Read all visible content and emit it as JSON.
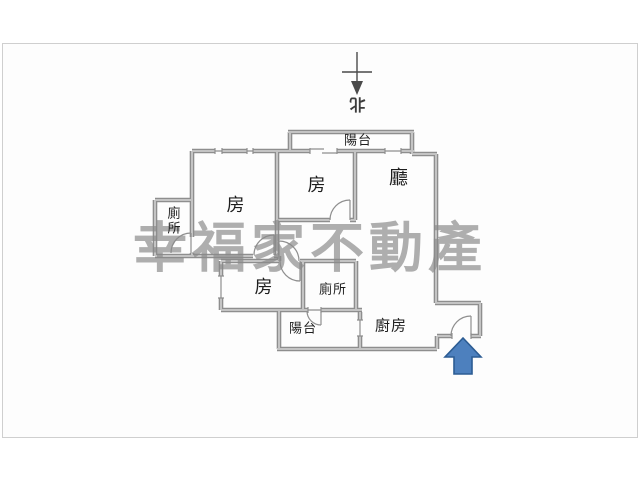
{
  "compass": {
    "north_label": "北"
  },
  "watermark": {
    "text": "幸福家不動產"
  },
  "rooms": {
    "balcony_top": "陽台",
    "living_room": "廳",
    "bedroom_top": "房",
    "bedroom_left": "房",
    "bedroom_bottom": "房",
    "toilet_left": "廁所",
    "toilet_bottom": "廁所",
    "balcony_bottom": "陽台",
    "kitchen": "廚房"
  },
  "colors": {
    "wall_edge": "#8e8e8e",
    "wall_core": "#c4c4c4",
    "thin_line": "#8f8f8f",
    "compass": "#4a4a4a",
    "arrow_fill": "#4d80be",
    "arrow_stroke": "#2c5c93"
  }
}
